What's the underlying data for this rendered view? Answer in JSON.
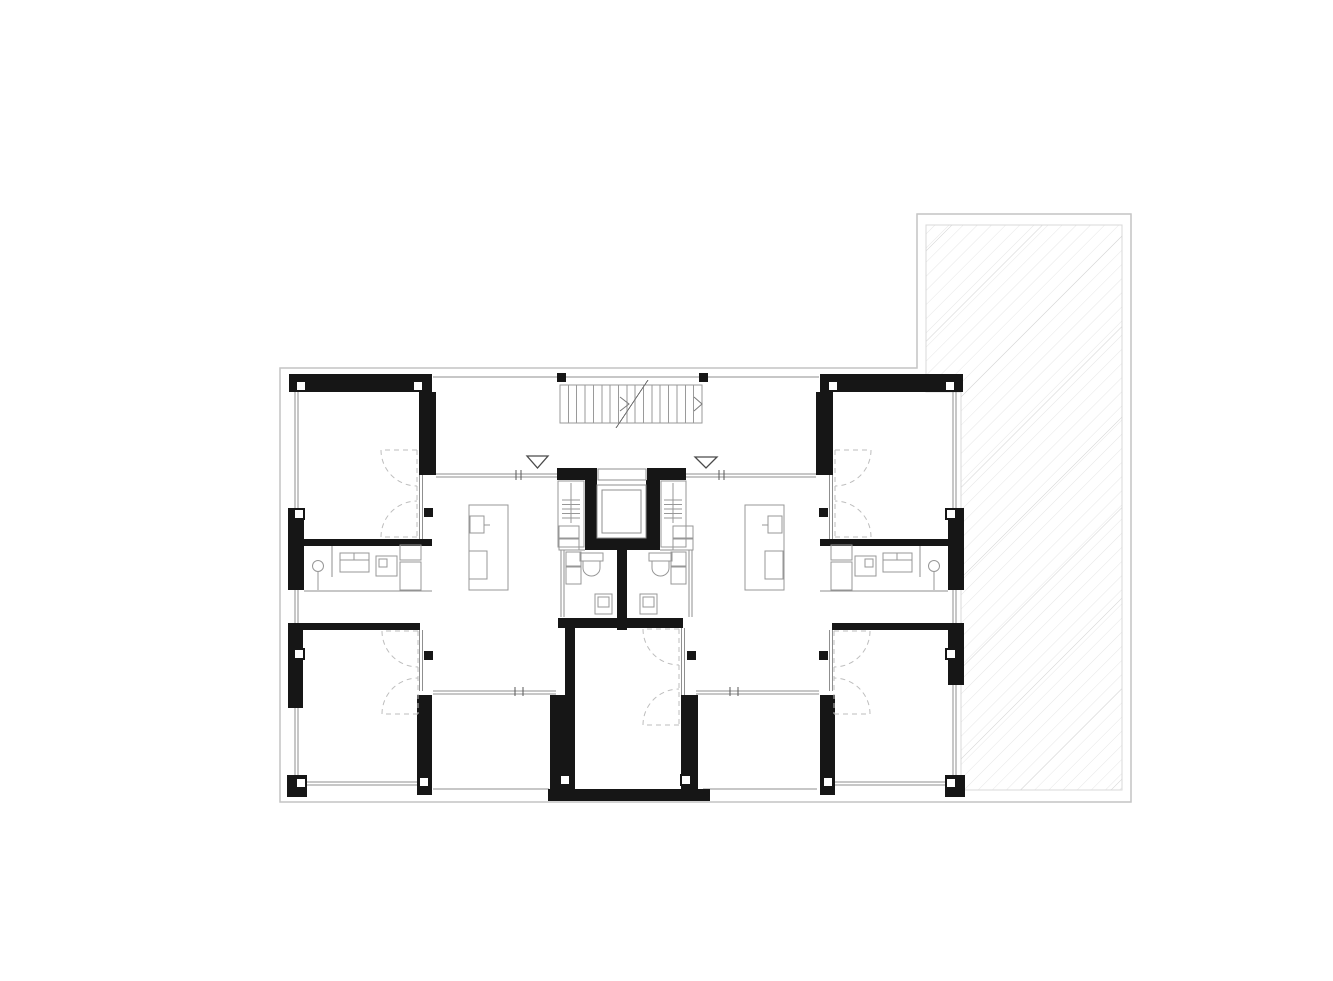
{
  "canvas": {
    "w": 1333,
    "h": 981,
    "bg": "#ffffff"
  },
  "palette": {
    "wall": "#161616",
    "thin": "#8f8f8f",
    "faint": "#c4c4c4",
    "dash": "#bdbdbd",
    "fixture": "#979797",
    "stair": "#9a9a9a",
    "arrow": "#7a7a7a",
    "hatch": "#e6e6e6",
    "hatch_dark": "#d4d4d4",
    "hatch_border": "#d8d8d8",
    "white": "#ffffff"
  },
  "boundary": {
    "points": "280,368 917,368 917,214 1131,214 1131,802 280,802"
  },
  "terrace": {
    "points": "926,225 1122,225 1122,790 961,790 961,392 926,392",
    "hatch_spacing": 10,
    "hatch_dark_spacing": 64
  },
  "walls": [
    [
      289,
      374,
      143,
      18
    ],
    [
      419,
      392,
      17,
      83
    ],
    [
      288,
      508,
      16,
      82
    ],
    [
      304,
      539,
      128,
      7
    ],
    [
      288,
      623,
      15,
      85
    ],
    [
      289,
      623,
      131,
      7
    ],
    [
      287,
      775,
      20,
      22
    ],
    [
      417,
      695,
      15,
      100
    ],
    [
      820,
      374,
      143,
      18
    ],
    [
      816,
      392,
      17,
      83
    ],
    [
      948,
      508,
      16,
      82
    ],
    [
      820,
      539,
      128,
      7
    ],
    [
      948,
      623,
      16,
      62
    ],
    [
      832,
      623,
      131,
      7
    ],
    [
      945,
      775,
      20,
      22
    ],
    [
      820,
      695,
      15,
      100
    ],
    [
      557,
      468,
      40,
      12
    ],
    [
      647,
      468,
      39,
      12
    ],
    [
      585,
      480,
      12,
      70
    ],
    [
      646,
      480,
      14,
      70
    ],
    [
      585,
      538,
      75,
      12
    ],
    [
      617,
      548,
      10,
      82
    ],
    [
      558,
      618,
      125,
      10
    ],
    [
      565,
      628,
      10,
      162
    ],
    [
      550,
      695,
      15,
      95
    ],
    [
      681,
      695,
      17,
      95
    ],
    [
      548,
      789,
      162,
      12
    ]
  ],
  "white_columns": [
    [
      296,
      381
    ],
    [
      413,
      381
    ],
    [
      828,
      381
    ],
    [
      945,
      381
    ],
    [
      294,
      509
    ],
    [
      946,
      509
    ],
    [
      294,
      649
    ],
    [
      946,
      649
    ],
    [
      296,
      778
    ],
    [
      946,
      778
    ],
    [
      419,
      777
    ],
    [
      823,
      777
    ],
    [
      560,
      775
    ],
    [
      681,
      775
    ]
  ],
  "black_columns": [
    [
      557,
      373
    ],
    [
      699,
      373
    ],
    [
      424,
      508
    ],
    [
      424,
      651
    ],
    [
      819,
      508
    ],
    [
      819,
      651
    ],
    [
      687,
      651
    ]
  ],
  "thin_lines": [
    [
      433,
      377,
      819,
      377
    ],
    [
      433,
      789,
      549,
      789
    ],
    [
      703,
      789,
      817,
      789
    ],
    [
      304,
      591,
      432,
      591
    ],
    [
      820,
      591,
      948,
      591
    ],
    [
      332,
      546,
      332,
      577
    ],
    [
      920,
      546,
      920,
      577
    ],
    [
      566,
      550,
      585,
      550
    ],
    [
      660,
      550,
      688,
      550
    ]
  ],
  "double_lines": [
    [
      296.5,
      392,
      296.5,
      508
    ],
    [
      296.5,
      590,
      296.5,
      623
    ],
    [
      296.5,
      708,
      296.5,
      775
    ],
    [
      954.5,
      392,
      954.5,
      508
    ],
    [
      954.5,
      590,
      954.5,
      623
    ],
    [
      954.5,
      685,
      954.5,
      775
    ],
    [
      307,
      783.5,
      417,
      783.5
    ],
    [
      835,
      783.5,
      945,
      783.5
    ],
    [
      436,
      475.5,
      557,
      475.5
    ],
    [
      686,
      475.5,
      816,
      475.5
    ],
    [
      433,
      692.5,
      556,
      692.5
    ],
    [
      696,
      692.5,
      819,
      692.5
    ],
    [
      562.5,
      550,
      562.5,
      617
    ],
    [
      690.5,
      550,
      690.5,
      617
    ],
    [
      421,
      475,
      421,
      539
    ],
    [
      831,
      475,
      831,
      539
    ],
    [
      421,
      630,
      421,
      691
    ],
    [
      831,
      630,
      831,
      691
    ],
    [
      683,
      628,
      683,
      695
    ]
  ],
  "ticks": [
    [
      516,
      470,
      516,
      480
    ],
    [
      521,
      470,
      521,
      480
    ],
    [
      719,
      470,
      719,
      480
    ],
    [
      724,
      470,
      724,
      480
    ],
    [
      515,
      687,
      515,
      696
    ],
    [
      523,
      687,
      523,
      696
    ],
    [
      730,
      687,
      730,
      696
    ],
    [
      738,
      687,
      738,
      696
    ]
  ],
  "stair": {
    "x": 560,
    "y": 385,
    "w": 142,
    "h": 38,
    "treads": 16,
    "break_line": [
      616,
      428,
      648,
      380
    ],
    "chevrons": [
      [
        620,
        397,
        629,
        404,
        620,
        411
      ],
      [
        694,
        397,
        702,
        404,
        694,
        411
      ]
    ]
  },
  "elevator": {
    "door": [
      598,
      469,
      48,
      11
    ],
    "cab": [
      597,
      485,
      49,
      53
    ],
    "cab_inner": [
      602,
      490,
      39,
      43
    ]
  },
  "shafts": {
    "frames": [
      [
        558,
        481,
        26,
        66
      ],
      [
        661,
        481,
        25,
        66
      ]
    ],
    "vlines": [
      [
        571,
        483,
        571,
        523
      ],
      [
        673,
        483,
        673,
        523
      ]
    ],
    "tick_ys": [
      500,
      504.5,
      509,
      513.5,
      518
    ],
    "tick_x": [
      [
        562,
        580
      ],
      [
        664,
        682
      ]
    ]
  },
  "doors": [
    {
      "x": 417,
      "y1": 450,
      "y2": 537,
      "r": 36,
      "dir": -1
    },
    {
      "x": 418,
      "y1": 631,
      "y2": 714,
      "r": 36,
      "dir": -1
    },
    {
      "x": 679,
      "y1": 629,
      "y2": 725,
      "r": 36,
      "dir": -1
    },
    {
      "x": 835,
      "y1": 450,
      "y2": 537,
      "r": 36,
      "dir": 1
    },
    {
      "x": 834,
      "y1": 631,
      "y2": 714,
      "r": 36,
      "dir": 1
    }
  ],
  "entry_markers": [
    {
      "points": "527,456 548,456 537.5,468"
    },
    {
      "points": "695,457 717,457 706,468"
    }
  ],
  "fixtures": [
    {
      "t": "rect",
      "n": "wc-cistern",
      "v": [
        580,
        553,
        23,
        8
      ]
    },
    {
      "t": "path",
      "n": "wc-toilet-bowl",
      "v": "M583,561 h17 v7 a8.5,8 0 0 1 -17,0 Z"
    },
    {
      "t": "rect",
      "n": "wc-cistern",
      "v": [
        649,
        553,
        23,
        8
      ]
    },
    {
      "t": "path",
      "n": "wc-toilet-bowl",
      "v": "M652,561 h17 v7 a8.5,8 0 0 1 -17,0 Z"
    },
    {
      "t": "rect",
      "n": "wc-sink",
      "v": [
        595,
        594,
        17,
        20
      ]
    },
    {
      "t": "rect",
      "n": "wc-sink-basin",
      "v": [
        598,
        597,
        11,
        10
      ]
    },
    {
      "t": "rect",
      "n": "wc-sink",
      "v": [
        640,
        594,
        17,
        20
      ]
    },
    {
      "t": "rect",
      "n": "wc-sink-basin",
      "v": [
        643,
        597,
        11,
        10
      ]
    },
    {
      "t": "rect",
      "n": "shaft-cabinet",
      "v": [
        559,
        526,
        20,
        12
      ]
    },
    {
      "t": "rect",
      "n": "shaft-cabinet",
      "v": [
        559,
        539,
        20,
        11
      ]
    },
    {
      "t": "rect",
      "n": "wc-cabinet",
      "v": [
        566,
        552,
        15,
        14
      ]
    },
    {
      "t": "rect",
      "n": "wc-cabinet",
      "v": [
        566,
        567,
        15,
        17
      ]
    },
    {
      "t": "rect",
      "n": "shaft-cabinet",
      "v": [
        673,
        526,
        20,
        12
      ]
    },
    {
      "t": "rect",
      "n": "shaft-cabinet",
      "v": [
        673,
        539,
        20,
        11
      ]
    },
    {
      "t": "rect",
      "n": "wc-cabinet",
      "v": [
        671,
        552,
        15,
        14
      ]
    },
    {
      "t": "rect",
      "n": "wc-cabinet",
      "v": [
        671,
        567,
        15,
        17
      ]
    },
    {
      "t": "rect",
      "n": "bath-washbasin",
      "v": [
        340,
        553,
        29,
        19
      ]
    },
    {
      "t": "line",
      "n": "bath-washbasin-edge",
      "v": [
        340,
        560,
        369,
        560
      ]
    },
    {
      "t": "line",
      "n": "bath-washbasin-tap",
      "v": [
        354,
        553,
        354,
        560
      ]
    },
    {
      "t": "rect",
      "n": "bath-appliance",
      "v": [
        376,
        556,
        21,
        20
      ]
    },
    {
      "t": "rect",
      "n": "bath-appliance-detail",
      "v": [
        379,
        559,
        8,
        8
      ]
    },
    {
      "t": "rect",
      "n": "bath-cabinet",
      "v": [
        400,
        545,
        21,
        15
      ]
    },
    {
      "t": "rect",
      "n": "bath-cabinet",
      "v": [
        400,
        562,
        21,
        28
      ]
    },
    {
      "t": "circle",
      "n": "bath-drain",
      "v": [
        318,
        566,
        5.5
      ]
    },
    {
      "t": "line",
      "n": "bath-drain-stem",
      "v": [
        318,
        572,
        318,
        590
      ]
    },
    {
      "t": "rect",
      "n": "bath-washbasin",
      "v": [
        883,
        553,
        29,
        19
      ]
    },
    {
      "t": "line",
      "n": "bath-washbasin-edge",
      "v": [
        883,
        560,
        912,
        560
      ]
    },
    {
      "t": "line",
      "n": "bath-washbasin-tap",
      "v": [
        897,
        553,
        897,
        560
      ]
    },
    {
      "t": "rect",
      "n": "bath-appliance",
      "v": [
        855,
        556,
        21,
        20
      ]
    },
    {
      "t": "rect",
      "n": "bath-appliance-detail",
      "v": [
        865,
        559,
        8,
        8
      ]
    },
    {
      "t": "rect",
      "n": "bath-cabinet",
      "v": [
        831,
        545,
        21,
        15
      ]
    },
    {
      "t": "rect",
      "n": "bath-cabinet",
      "v": [
        831,
        562,
        21,
        28
      ]
    },
    {
      "t": "circle",
      "n": "bath-drain",
      "v": [
        934,
        566,
        5.5
      ]
    },
    {
      "t": "line",
      "n": "bath-drain-stem",
      "v": [
        934,
        572,
        934,
        590
      ]
    },
    {
      "t": "rect",
      "n": "kitchen-island",
      "v": [
        469,
        505,
        39,
        85
      ]
    },
    {
      "t": "rect",
      "n": "kitchen-sink",
      "v": [
        470,
        516,
        14,
        17
      ]
    },
    {
      "t": "line",
      "n": "kitchen-tap",
      "v": [
        484,
        525,
        490,
        525
      ]
    },
    {
      "t": "rect",
      "n": "kitchen-stove",
      "v": [
        469,
        551,
        18,
        28
      ]
    },
    {
      "t": "rect",
      "n": "kitchen-island",
      "v": [
        745,
        505,
        39,
        85
      ]
    },
    {
      "t": "rect",
      "n": "kitchen-sink",
      "v": [
        768,
        516,
        14,
        17
      ]
    },
    {
      "t": "line",
      "n": "kitchen-tap",
      "v": [
        762,
        525,
        768,
        525
      ]
    },
    {
      "t": "rect",
      "n": "kitchen-stove",
      "v": [
        765,
        551,
        18,
        28
      ]
    }
  ]
}
